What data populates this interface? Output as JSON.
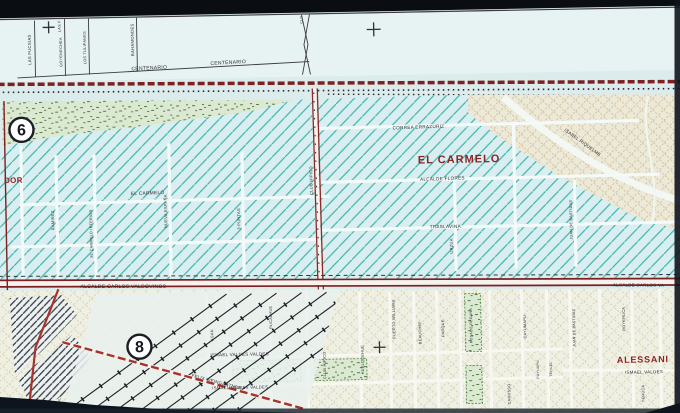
{
  "photo": {
    "kind": "photographed paper street map",
    "sheet_markers": [
      "6",
      "8"
    ]
  },
  "colors": {
    "ink": "#2b2b33",
    "darkred": "#8e2326",
    "maroon": "#7c2022",
    "road_red": "#a8332e",
    "hatch_teal": "#41b4aa",
    "paper": "#dcecec",
    "tan": "#c8b384",
    "park_green": "#55803f"
  },
  "map": {
    "district_labels": [
      "EL CARMELO",
      "ALESSANI"
    ],
    "labels": [
      {
        "id": "las-fucsias",
        "text": "LAS FUCSIAS",
        "x": 34,
        "y": 44,
        "size": 4.2,
        "vertical": true
      },
      {
        "id": "las-f-partial",
        "text": "LAS F",
        "x": 64,
        "y": 21,
        "size": 3.8,
        "vertical": true
      },
      {
        "id": "goyenechea",
        "text": "GOYENECHEA",
        "x": 65,
        "y": 47,
        "size": 3.8,
        "vertical": true
      },
      {
        "id": "los-tulipanes",
        "text": "LOS TULIPANES",
        "x": 89,
        "y": 43,
        "size": 3.8,
        "vertical": true
      },
      {
        "id": "bahamondes",
        "text": "BAHAMONDES",
        "x": 137,
        "y": 36,
        "size": 4.2,
        "vertical": true
      },
      {
        "id": "centenario-1",
        "text": "CENTENARIO",
        "x": 152,
        "y": 66,
        "size": 5,
        "rot": -2
      },
      {
        "id": "centenario-2",
        "text": "CENTENARIO",
        "x": 231,
        "y": 62,
        "size": 5,
        "rot": -2
      },
      {
        "id": "clo",
        "text": "CLO",
        "x": 306,
        "y": 19,
        "size": 3.4,
        "vertical": true
      },
      {
        "id": "correa-errazuriz",
        "text": "CORREA ERRAZURIZ",
        "x": 420,
        "y": 130,
        "size": 4.6,
        "rot": -1
      },
      {
        "id": "el-carmelo-district",
        "text": "EL CARMELO",
        "x": 460,
        "y": 165,
        "size": 11,
        "bold": true,
        "color": "darkred",
        "spacing": 1
      },
      {
        "id": "alcalde-flores",
        "text": "ALCALDE FLORES",
        "x": 443,
        "y": 182,
        "size": 4.6,
        "rot": -1
      },
      {
        "id": "traslavina",
        "text": "TRASLAVINA",
        "x": 445,
        "y": 230,
        "size": 4.6
      },
      {
        "id": "el-carmelo-street",
        "text": "EL CARMELO",
        "x": 148,
        "y": 191,
        "size": 4.8,
        "rot": -1
      },
      {
        "id": "ramirez",
        "text": "RAMIREZ",
        "x": 54,
        "y": 215,
        "size": 4,
        "vertical": true
      },
      {
        "id": "el-carmelo-interior",
        "text": "EL CARMELO INTERIOR",
        "x": 92,
        "y": 229,
        "size": 3.7,
        "vertical": true
      },
      {
        "id": "nueva-espana",
        "text": "NUEVA ESPAÑA",
        "x": 167,
        "y": 208,
        "size": 4,
        "vertical": true
      },
      {
        "id": "tres-puntas",
        "text": "3 PUNTAS",
        "x": 240,
        "y": 217,
        "size": 4,
        "vertical": true
      },
      {
        "id": "club-hipico-north",
        "text": "CLUB HIPICO",
        "x": 313,
        "y": 180,
        "size": 4,
        "vertical": true
      },
      {
        "id": "urzua",
        "text": "URZUA",
        "x": 452,
        "y": 248,
        "size": 4,
        "vertical": true
      },
      {
        "id": "juan-de-bastidas-north",
        "text": "JUAN DE BASTIDAS",
        "x": 572,
        "y": 224,
        "size": 3.7,
        "vertical": true
      },
      {
        "id": "isabel-riquelme",
        "text": "ISABEL RIQUELME",
        "x": 583,
        "y": 148,
        "size": 4.4,
        "rot": 37
      },
      {
        "id": "dor-partial",
        "text": "DOR",
        "x": 14,
        "y": 177,
        "size": 8,
        "bold": true,
        "color": "darkred"
      },
      {
        "id": "alcalde-carlos-valdovinos",
        "text": "ALCALDE CARLOS VALDOVINOS",
        "x": 122,
        "y": 284,
        "size": 5,
        "rot": 1
      },
      {
        "id": "alcalde-carlos-va-partial",
        "text": "ALCALDE CARLOS VA",
        "x": 637,
        "y": 292,
        "size": 4.4,
        "rot": 1.5
      },
      {
        "id": "ismael-valdes-valdes-1",
        "text": "ISMAEL VALDES VALDES",
        "x": 237,
        "y": 354,
        "size": 4.4
      },
      {
        "id": "ismael-valdes-valdes-2",
        "text": "ISMAEL VALDES VALDES",
        "x": 237,
        "y": 387,
        "size": 4.2
      },
      {
        "id": "felix-weingartner",
        "text": "FELIX WEINGARTNER",
        "x": 213,
        "y": 381,
        "size": 4.4,
        "rot": 16
      },
      {
        "id": "ugan",
        "text": "UGAN",
        "x": 211,
        "y": 333,
        "size": 3.8,
        "vertical": true
      },
      {
        "id": "rucalhue",
        "text": "RUCALHUE",
        "x": 270,
        "y": 316,
        "size": 3.8,
        "vertical": true
      },
      {
        "id": "club-hipico-south",
        "text": "CLUB HIPICO",
        "x": 323,
        "y": 365,
        "size": 3.8,
        "vertical": true
      },
      {
        "id": "huelquehue",
        "text": "HUELQUEHUE",
        "x": 361,
        "y": 360,
        "size": 3.8,
        "vertical": true
      },
      {
        "id": "puerto-williams",
        "text": "PUERTO WILLIAMS",
        "x": 393,
        "y": 320,
        "size": 3.8,
        "vertical": true
      },
      {
        "id": "beauchef",
        "text": "BEAUCHEF",
        "x": 419,
        "y": 334,
        "size": 3.8,
        "vertical": true
      },
      {
        "id": "parque",
        "text": "PARQUE",
        "x": 442,
        "y": 330,
        "size": 3.8,
        "vertical": true
      },
      {
        "id": "rosalie-regana",
        "text": "ROSALIE REGANA",
        "x": 470,
        "y": 328,
        "size": 3.5,
        "vertical": true
      },
      {
        "id": "cayumapu",
        "text": "CAYUMAPU",
        "x": 524,
        "y": 330,
        "size": 3.8,
        "vertical": true
      },
      {
        "id": "carusso",
        "text": "CARUSSO",
        "x": 507,
        "y": 397,
        "size": 3.8,
        "vertical": true
      },
      {
        "id": "puyuapu",
        "text": "PUYUAPU",
        "x": 536,
        "y": 373,
        "size": 3.4,
        "vertical": true
      },
      {
        "id": "tehuel",
        "text": "TEHUEL",
        "x": 549,
        "y": 373,
        "size": 3.4,
        "vertical": true
      },
      {
        "id": "juan-de-bastidas-south",
        "text": "JUAN DE BASTIDAS",
        "x": 573,
        "y": 332,
        "size": 3.5,
        "vertical": true
      },
      {
        "id": "royeruca",
        "text": "ROYERUCA",
        "x": 623,
        "y": 324,
        "size": 3.8,
        "vertical": true
      },
      {
        "id": "alessani-district",
        "text": "ALESSANI",
        "x": 640,
        "y": 368,
        "size": 9,
        "bold": true,
        "color": "darkred",
        "spacing": 0.8
      },
      {
        "id": "ismael-valdes",
        "text": "ISMAEL VALDES",
        "x": 641,
        "y": 379,
        "size": 4.4
      },
      {
        "id": "yeruca",
        "text": "YERUCA",
        "x": 641,
        "y": 399,
        "size": 3.8,
        "vertical": true
      },
      {
        "id": "uer",
        "text": "U.E.R.",
        "x": 57,
        "y": 398,
        "size": 3.2,
        "vertical": true
      }
    ],
    "markers": [
      {
        "id": "sheet-6",
        "number": "6",
        "x": 23,
        "y": 124,
        "r": 12
      },
      {
        "id": "sheet-8",
        "number": "8",
        "x": 137,
        "y": 343,
        "r": 12
      }
    ],
    "cross_marks": [
      {
        "x": 52,
        "y": 22,
        "s": 6
      },
      {
        "x": 377,
        "y": 30,
        "s": 7
      },
      {
        "x": 377,
        "y": 348,
        "s": 6
      }
    ]
  }
}
